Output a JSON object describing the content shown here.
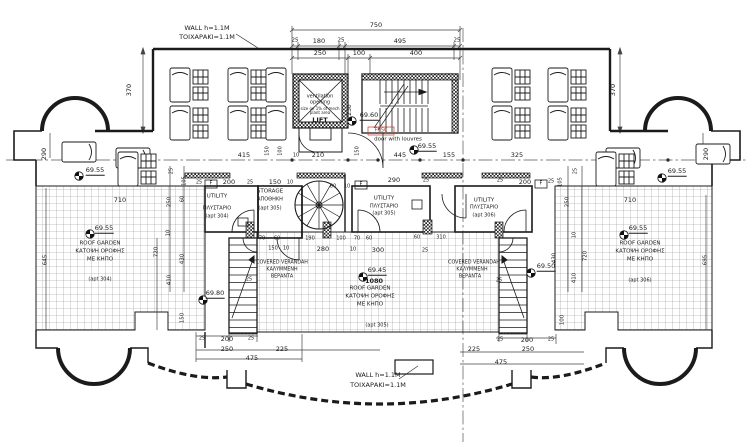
{
  "drawing": {
    "background": "#ffffff",
    "line_color": "#1b1b1b",
    "accent_red": "#c0392b"
  },
  "labels": [
    {
      "n": "note-wall-top-line1",
      "t": "WALL h=1.1M",
      "x": 207,
      "y": 28
    },
    {
      "n": "note-wall-top-line2",
      "t": "ΤΟΙΧΑΡΑΚΙ=1.1M",
      "x": 207,
      "y": 37
    },
    {
      "n": "note-wall-bottom-line1",
      "t": "WALL h=1.1M",
      "x": 378,
      "y": 375
    },
    {
      "n": "note-wall-bottom-line2",
      "t": "ΤΟΙΧΑΡΑΚΙ=1.1M",
      "x": 378,
      "y": 385
    },
    {
      "n": "dim-750",
      "t": "750",
      "x": 376,
      "y": 25
    },
    {
      "n": "dim-25-a",
      "t": "25",
      "x": 295,
      "y": 41,
      "s": 5.5
    },
    {
      "n": "dim-180",
      "t": "180",
      "x": 319,
      "y": 41
    },
    {
      "n": "dim-25-b",
      "t": "25",
      "x": 341,
      "y": 41,
      "s": 5.5
    },
    {
      "n": "dim-495",
      "t": "495",
      "x": 400,
      "y": 41
    },
    {
      "n": "dim-25-c",
      "t": "25",
      "x": 457,
      "y": 41,
      "s": 5.5
    },
    {
      "n": "dim-250-top",
      "t": "250",
      "x": 320,
      "y": 53
    },
    {
      "n": "dim-100-top",
      "t": "100",
      "x": 359,
      "y": 53
    },
    {
      "n": "dim-400-top",
      "t": "400",
      "x": 416,
      "y": 53
    },
    {
      "n": "dim-370-left",
      "t": "370",
      "x": 129,
      "y": 90,
      "r": -90
    },
    {
      "n": "dim-370-right",
      "t": "370",
      "x": 613,
      "y": 90,
      "r": -90
    },
    {
      "n": "dim-290-left",
      "t": "290",
      "x": 44,
      "y": 154,
      "r": -90
    },
    {
      "n": "dim-290-right",
      "t": "290",
      "x": 706,
      "y": 154,
      "r": -90
    },
    {
      "n": "dim-415",
      "t": "415",
      "x": 244,
      "y": 155
    },
    {
      "n": "dim-150-cl-left",
      "t": "150",
      "x": 268,
      "y": 151,
      "r": -90,
      "s": 5
    },
    {
      "n": "dim-100-cl",
      "t": "100",
      "x": 281,
      "y": 151,
      "r": -90,
      "s": 5
    },
    {
      "n": "dim-10-cl-a",
      "t": "10",
      "x": 296,
      "y": 156,
      "s": 5
    },
    {
      "n": "dim-210",
      "t": "210",
      "x": 318,
      "y": 155
    },
    {
      "n": "dim-150-cl-right",
      "t": "150",
      "x": 358,
      "y": 151,
      "r": -90,
      "s": 5
    },
    {
      "n": "dim-445",
      "t": "445",
      "x": 400,
      "y": 155
    },
    {
      "n": "dim-155",
      "t": "155",
      "x": 449,
      "y": 155
    },
    {
      "n": "dim-325",
      "t": "325",
      "x": 517,
      "y": 155
    },
    {
      "n": "lift-note-line1",
      "t": "ventilation",
      "x": 320,
      "y": 97,
      "s": 5
    },
    {
      "n": "lift-note-line2",
      "t": "opening",
      "x": 320,
      "y": 103,
      "s": 5
    },
    {
      "n": "lift-note-line3",
      "t": "size on 1% of mech",
      "x": 320,
      "y": 109,
      "s": 4
    },
    {
      "n": "lift-note-line4",
      "t": "plant area",
      "x": 320,
      "y": 113,
      "s": 4
    },
    {
      "n": "lift-label",
      "t": "LIFT",
      "x": 320,
      "y": 120,
      "b": 1
    },
    {
      "n": "dim-230-lift",
      "t": "230",
      "x": 350,
      "y": 110,
      "r": -90,
      "s": 6
    },
    {
      "n": "level-69-60",
      "t": "69.60",
      "x": 369,
      "y": 116,
      "u": 1
    },
    {
      "n": "frsc-label",
      "t": "FRSC",
      "x": 381,
      "y": 131,
      "s": 5,
      "c": "#c0392b"
    },
    {
      "n": "door-louvres-note",
      "t": "door with louvres",
      "x": 398,
      "y": 140,
      "s": 5.5
    },
    {
      "n": "level-69-55-door",
      "t": "69.55",
      "x": 427,
      "y": 147,
      "u": 1
    },
    {
      "n": "dim-25-rooml-a",
      "t": "25",
      "x": 199,
      "y": 183,
      "s": 5
    },
    {
      "n": "fbox-left-label",
      "t": "F",
      "x": 211,
      "y": 184,
      "s": 5
    },
    {
      "n": "dim-200-rooml",
      "t": "200",
      "x": 229,
      "y": 182
    },
    {
      "n": "dim-25-rooml-b",
      "t": "25",
      "x": 250,
      "y": 183,
      "s": 5
    },
    {
      "n": "dim-150-room",
      "t": "150",
      "x": 275,
      "y": 182
    },
    {
      "n": "dim-10-room-a",
      "t": "10",
      "x": 290,
      "y": 183,
      "s": 5
    },
    {
      "n": "dim-80-room",
      "t": "80",
      "x": 333,
      "y": 187,
      "s": 5
    },
    {
      "n": "dim-10-room-b",
      "t": "10",
      "x": 347,
      "y": 187,
      "s": 5
    },
    {
      "n": "fbox-mid-label",
      "t": "F",
      "x": 361,
      "y": 185,
      "s": 5
    },
    {
      "n": "dim-290-room",
      "t": "290",
      "x": 394,
      "y": 180
    },
    {
      "n": "dim-25-room-c",
      "t": "25",
      "x": 426,
      "y": 181,
      "s": 5
    },
    {
      "n": "dim-25-roomr-a",
      "t": "25",
      "x": 500,
      "y": 181,
      "s": 5
    },
    {
      "n": "dim-200-roomr",
      "t": "200",
      "x": 525,
      "y": 182
    },
    {
      "n": "fbox-right-label",
      "t": "F",
      "x": 541,
      "y": 184,
      "s": 5
    },
    {
      "n": "dim-25-roomr-b",
      "t": "25",
      "x": 551,
      "y": 182,
      "s": 5
    },
    {
      "n": "room-utility304-line1",
      "t": "UTILITY",
      "x": 217,
      "y": 197,
      "s": 5.5
    },
    {
      "n": "room-utility304-line2",
      "t": "ΠΛΥΣΤΑΡΙΟ",
      "x": 217,
      "y": 209,
      "s": 5
    },
    {
      "n": "room-utility304-line3",
      "t": "(apt 304)",
      "x": 217,
      "y": 217,
      "s": 5
    },
    {
      "n": "room-storage-line1",
      "t": "STORAGE",
      "x": 270,
      "y": 192,
      "s": 5.5
    },
    {
      "n": "room-storage-line2",
      "t": "ΑΠΟΘΗΚΗ",
      "x": 270,
      "y": 200,
      "s": 5
    },
    {
      "n": "room-storage-line3",
      "t": "(apt 305)",
      "x": 270,
      "y": 209,
      "s": 5
    },
    {
      "n": "room-utility305-line1",
      "t": "UTILITY",
      "x": 384,
      "y": 199,
      "s": 5.5
    },
    {
      "n": "room-utility305-line2",
      "t": "ΠΛΥΣΤΑΡΙΟ",
      "x": 384,
      "y": 207,
      "s": 5
    },
    {
      "n": "room-utility305-line3",
      "t": "(apt 305)",
      "x": 384,
      "y": 214,
      "s": 5
    },
    {
      "n": "room-utility306-line1",
      "t": "UTILITY",
      "x": 484,
      "y": 201,
      "s": 5.5
    },
    {
      "n": "room-utility306-line2",
      "t": "ΠΛΥΣΤΑΡΙΟ",
      "x": 484,
      "y": 208,
      "s": 5
    },
    {
      "n": "room-utility306-line3",
      "t": "(apt 306)",
      "x": 484,
      "y": 216,
      "s": 5
    },
    {
      "n": "dim-25-lstack",
      "t": "25",
      "x": 172,
      "y": 171,
      "r": -90,
      "s": 5
    },
    {
      "n": "dim-105-lstack",
      "t": "105",
      "x": 185,
      "y": 181,
      "r": -90,
      "s": 5
    },
    {
      "n": "dim-250-lstack",
      "t": "250",
      "x": 170,
      "y": 202,
      "r": -90,
      "s": 5.5
    },
    {
      "n": "dim-60-lstack",
      "t": "60",
      "x": 183,
      "y": 199,
      "r": -90,
      "s": 5
    },
    {
      "n": "dim-10-lstack",
      "t": "10",
      "x": 169,
      "y": 233,
      "r": -90,
      "s": 5
    },
    {
      "n": "dim-720-lstack",
      "t": "720",
      "x": 157,
      "y": 252,
      "r": -90,
      "s": 5.5
    },
    {
      "n": "dim-430-lstack",
      "t": "430",
      "x": 183,
      "y": 259,
      "r": -90,
      "s": 5.5
    },
    {
      "n": "dim-410-lstack",
      "t": "410",
      "x": 170,
      "y": 280,
      "r": -90,
      "s": 5.5
    },
    {
      "n": "dim-150-lstair",
      "t": "150",
      "x": 183,
      "y": 318,
      "r": -90,
      "s": 5.5
    },
    {
      "n": "dim-645-left",
      "t": "645",
      "x": 46,
      "y": 260,
      "r": -90,
      "s": 5.5
    },
    {
      "n": "dim-105-rstack",
      "t": "105",
      "x": 561,
      "y": 182,
      "r": -90,
      "s": 5
    },
    {
      "n": "dim-25-rstack",
      "t": "25",
      "x": 576,
      "y": 171,
      "r": -90,
      "s": 5
    },
    {
      "n": "dim-250-rstack",
      "t": "250",
      "x": 568,
      "y": 202,
      "r": -90,
      "s": 5.5
    },
    {
      "n": "dim-10-rstack",
      "t": "10",
      "x": 575,
      "y": 235,
      "r": -90,
      "s": 5
    },
    {
      "n": "dim-720-rstack",
      "t": "720",
      "x": 586,
      "y": 256,
      "r": -90,
      "s": 5.5
    },
    {
      "n": "dim-430-rstack",
      "t": "430",
      "x": 555,
      "y": 258,
      "r": -90,
      "s": 5.5
    },
    {
      "n": "dim-410-rstack",
      "t": "410",
      "x": 575,
      "y": 278,
      "r": -90,
      "s": 5.5
    },
    {
      "n": "dim-100-rstair",
      "t": "100",
      "x": 563,
      "y": 320,
      "r": -90,
      "s": 5.5
    },
    {
      "n": "dim-695-right",
      "t": "695",
      "x": 706,
      "y": 260,
      "r": -90,
      "s": 5.5
    },
    {
      "n": "dim-710-left",
      "t": "710",
      "x": 120,
      "y": 200
    },
    {
      "n": "level-69-55-lgarden",
      "t": "69.55",
      "x": 104,
      "y": 229,
      "u": 1
    },
    {
      "n": "lgarden-line1",
      "t": "ROOF GARDEN",
      "x": 100,
      "y": 244,
      "s": 5.5
    },
    {
      "n": "lgarden-line2",
      "t": "ΚΑΤΟΨΗ ΟΡΟΦΗΣ",
      "x": 100,
      "y": 252,
      "s": 5.5
    },
    {
      "n": "lgarden-line3",
      "t": "ΜΕ ΚΗΠΟ",
      "x": 100,
      "y": 260,
      "s": 5.5
    },
    {
      "n": "lgarden-apt",
      "t": "(apt 304)",
      "x": 100,
      "y": 280,
      "s": 5
    },
    {
      "n": "dim-710-right",
      "t": "710",
      "x": 630,
      "y": 200
    },
    {
      "n": "level-69-55-rgarden",
      "t": "69.55",
      "x": 638,
      "y": 229,
      "u": 1
    },
    {
      "n": "rgarden-line1",
      "t": "ROOF GARDEN",
      "x": 640,
      "y": 244,
      "s": 5.5
    },
    {
      "n": "rgarden-line2",
      "t": "ΚΑΤΟΨΗ ΟΡΟΦΗΣ",
      "x": 640,
      "y": 252,
      "s": 5.5
    },
    {
      "n": "rgarden-line3",
      "t": "ΜΕ ΚΗΠΟ",
      "x": 640,
      "y": 260,
      "s": 5.5
    },
    {
      "n": "rgarden-apt",
      "t": "(apt 306)",
      "x": 640,
      "y": 281,
      "s": 5
    },
    {
      "n": "level-69-45-center",
      "t": "69.45",
      "x": 377,
      "y": 271,
      "u": 1
    },
    {
      "n": "dim-1080",
      "t": "1080",
      "x": 374,
      "y": 281,
      "b": 1
    },
    {
      "n": "cgarden-line1",
      "t": "ROOF GARDEN",
      "x": 370,
      "y": 289,
      "s": 5.5
    },
    {
      "n": "cgarden-line2",
      "t": "ΚΑΤΟΨΗ ΟΡΟΦΗΣ",
      "x": 370,
      "y": 297,
      "s": 5.5
    },
    {
      "n": "cgarden-line3",
      "t": "ΜΕ ΚΗΠΟ",
      "x": 370,
      "y": 305,
      "s": 5.5
    },
    {
      "n": "cgarden-apt",
      "t": "(apt 305)",
      "x": 377,
      "y": 326,
      "s": 5
    },
    {
      "n": "level-69-55-lterrace",
      "t": "69.55",
      "x": 95,
      "y": 171,
      "u": 1
    },
    {
      "n": "level-69-55-rterrace",
      "t": "69.55",
      "x": 677,
      "y": 172,
      "u": 1
    },
    {
      "n": "level-69-80-lstair",
      "t": "69.80",
      "x": 215,
      "y": 294,
      "u": 1
    },
    {
      "n": "level-69-50-rstair",
      "t": "69.50",
      "x": 546,
      "y": 267,
      "u": 1
    },
    {
      "n": "lverandah-line1",
      "t": "COVERED VERANDAH",
      "x": 282,
      "y": 264,
      "s": 4.8
    },
    {
      "n": "lverandah-line2",
      "t": "ΚΑΛΥΜΜΕΝΗ",
      "x": 282,
      "y": 271,
      "s": 4.8
    },
    {
      "n": "lverandah-line3",
      "t": "ΒΕΡΑΝΤΑ",
      "x": 282,
      "y": 278,
      "s": 4.8
    },
    {
      "n": "rverandah-line1",
      "t": "COVERED VERANDAH",
      "x": 474,
      "y": 264,
      "s": 4.8
    },
    {
      "n": "rverandah-line2",
      "t": "ΚΑΛΥΜΜΕΝΗ",
      "x": 472,
      "y": 271,
      "s": 4.8
    },
    {
      "n": "rverandah-line3",
      "t": "ΒΕΡΑΝΤΑ",
      "x": 470,
      "y": 278,
      "s": 4.8
    },
    {
      "n": "dim-70-ver-a",
      "t": "70",
      "x": 262,
      "y": 239,
      "s": 5
    },
    {
      "n": "dim-60-ver-a",
      "t": "60",
      "x": 277,
      "y": 239,
      "s": 5
    },
    {
      "n": "dim-190-ver",
      "t": "190",
      "x": 310,
      "y": 239,
      "s": 5
    },
    {
      "n": "dim-100-ver",
      "t": "100",
      "x": 341,
      "y": 239,
      "s": 5
    },
    {
      "n": "dim-70-ver-b",
      "t": "70",
      "x": 357,
      "y": 239,
      "s": 5
    },
    {
      "n": "dim-60-ver-b",
      "t": "60",
      "x": 369,
      "y": 239,
      "s": 5
    },
    {
      "n": "dim-150-ver",
      "t": "150",
      "x": 273,
      "y": 249,
      "s": 5
    },
    {
      "n": "dim-10-ver-a",
      "t": "10",
      "x": 286,
      "y": 249,
      "s": 5
    },
    {
      "n": "dim-280-ver",
      "t": "280",
      "x": 323,
      "y": 249
    },
    {
      "n": "dim-10-ver-b",
      "t": "10",
      "x": 353,
      "y": 250,
      "s": 5
    },
    {
      "n": "dim-300-ver",
      "t": "300",
      "x": 378,
      "y": 250
    },
    {
      "n": "dim-25-ver-a",
      "t": "25",
      "x": 425,
      "y": 251,
      "s": 5
    },
    {
      "n": "dim-60-ver-c",
      "t": "60",
      "x": 417,
      "y": 238,
      "s": 5
    },
    {
      "n": "dim-310-ver",
      "t": "310",
      "x": 441,
      "y": 238,
      "s": 5
    },
    {
      "n": "dim-25-lstair",
      "t": "25",
      "x": 249,
      "y": 280,
      "s": 5
    },
    {
      "n": "dim-25-rstair",
      "t": "25",
      "x": 499,
      "y": 281,
      "s": 5
    },
    {
      "n": "dim-25-bl-a",
      "t": "25",
      "x": 202,
      "y": 339,
      "s": 5
    },
    {
      "n": "dim-200-bl",
      "t": "200",
      "x": 227,
      "y": 339
    },
    {
      "n": "dim-25-bl-b",
      "t": "25",
      "x": 251,
      "y": 339,
      "s": 5
    },
    {
      "n": "dim-250-bl",
      "t": "250",
      "x": 227,
      "y": 349
    },
    {
      "n": "dim-225-bl",
      "t": "225",
      "x": 282,
      "y": 349
    },
    {
      "n": "dim-475-bl",
      "t": "475",
      "x": 252,
      "y": 358
    },
    {
      "n": "dim-25-br-a",
      "t": "25",
      "x": 500,
      "y": 340,
      "s": 5
    },
    {
      "n": "dim-200-br",
      "t": "200",
      "x": 527,
      "y": 340
    },
    {
      "n": "dim-25-br-b",
      "t": "25",
      "x": 551,
      "y": 340,
      "s": 5
    },
    {
      "n": "dim-225-br",
      "t": "225",
      "x": 474,
      "y": 349
    },
    {
      "n": "dim-250-br",
      "t": "250",
      "x": 528,
      "y": 349
    },
    {
      "n": "dim-475-br",
      "t": "475",
      "x": 501,
      "y": 362
    }
  ]
}
